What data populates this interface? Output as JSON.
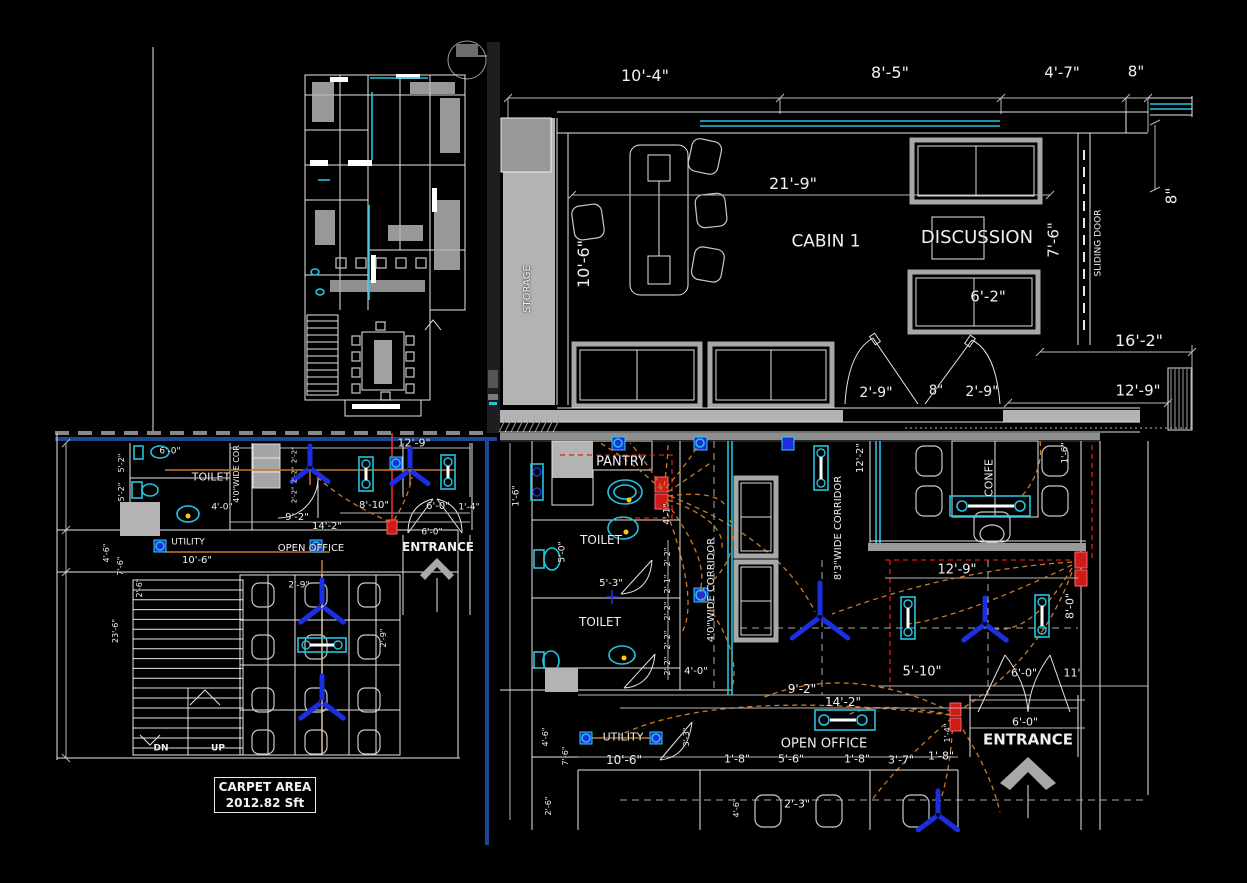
{
  "title": "Office Floor Plan CAD Drawing",
  "colors": {
    "bg": "#000000",
    "line": "#e6e6e6",
    "grayfill": "#b3b3b3",
    "cyan": "#25c4de",
    "blue": "#1c2fe0",
    "orange": "#c87a28",
    "red": "#e01818",
    "navy": "#1c4893",
    "yellow": "#ffcc00",
    "text": "#f0f0f0"
  },
  "carpet_area": {
    "line1": "CARPET AREA",
    "line2": "2012.82 Sft"
  },
  "labels": [
    {
      "n": "dim-10-4",
      "t": "10'-4\"",
      "x": 645,
      "y": 76,
      "s": 16
    },
    {
      "n": "dim-8-5",
      "t": "8'-5\"",
      "x": 890,
      "y": 73,
      "s": 16
    },
    {
      "n": "dim-4-7",
      "t": "4'-7\"",
      "x": 1062,
      "y": 73,
      "s": 15
    },
    {
      "n": "dim-8in-top",
      "t": "8\"",
      "x": 1136,
      "y": 72,
      "s": 15
    },
    {
      "n": "dim-8in-right",
      "t": "8\"",
      "x": 1172,
      "y": 196,
      "s": 15,
      "r": -90
    },
    {
      "n": "dim-21-9",
      "t": "21'-9\"",
      "x": 793,
      "y": 184,
      "s": 16
    },
    {
      "n": "dim-10-6-cabin",
      "t": "10'-6\"",
      "x": 584,
      "y": 264,
      "s": 16,
      "r": -90
    },
    {
      "n": "room-label-cabin1",
      "t": "CABIN 1",
      "x": 826,
      "y": 242,
      "s": 17
    },
    {
      "n": "room-label-discussion",
      "t": "DISCUSSION",
      "x": 977,
      "y": 238,
      "s": 18
    },
    {
      "n": "dim-7-6-right",
      "t": "7'-6\"",
      "x": 1054,
      "y": 240,
      "s": 15,
      "r": -90
    },
    {
      "n": "label-sliding-door",
      "t": "SLIDING DOOR",
      "x": 1099,
      "y": 243,
      "s": 9,
      "r": -90
    },
    {
      "n": "dim-6-2",
      "t": "6'-2\"",
      "x": 988,
      "y": 297,
      "s": 15
    },
    {
      "n": "dim-2-9-a",
      "t": "2'-9\"",
      "x": 876,
      "y": 393,
      "s": 14
    },
    {
      "n": "dim-8in-door",
      "t": "8\"",
      "x": 936,
      "y": 391,
      "s": 13
    },
    {
      "n": "dim-2-9-b",
      "t": "2'-9\"",
      "x": 982,
      "y": 392,
      "s": 14
    },
    {
      "n": "dim-16-2",
      "t": "16'-2\"",
      "x": 1139,
      "y": 341,
      "s": 16
    },
    {
      "n": "dim-12-9-top",
      "t": "12'-9\"",
      "x": 1138,
      "y": 391,
      "s": 15
    },
    {
      "n": "room-label-storage",
      "t": "STORAGE",
      "x": 528,
      "y": 289,
      "s": 10,
      "r": -90
    },
    {
      "n": "dim-12-9-c",
      "t": "12'-9\"",
      "x": 414,
      "y": 443,
      "s": 11
    },
    {
      "n": "dim-6-0-c1",
      "t": "6'-0\"",
      "x": 170,
      "y": 452,
      "s": 9
    },
    {
      "n": "room-label-toilet-c",
      "t": "TOILET",
      "x": 211,
      "y": 477,
      "s": 11
    },
    {
      "n": "dim-5-2-a",
      "t": "5'-2\"",
      "x": 122,
      "y": 463,
      "s": 8,
      "r": -90
    },
    {
      "n": "dim-5-2-b",
      "t": "5'-2\"",
      "x": 122,
      "y": 492,
      "s": 8,
      "r": -90
    },
    {
      "n": "label-cor-c",
      "t": "4'0\"WIDE COR",
      "x": 237,
      "y": 474,
      "s": 8,
      "r": -90
    },
    {
      "n": "dim-2-2-c1",
      "t": "2'-2\"",
      "x": 295,
      "y": 455,
      "s": 7,
      "r": -90
    },
    {
      "n": "dim-2-2-c2",
      "t": "2'-2\"",
      "x": 295,
      "y": 475,
      "s": 7,
      "r": -90
    },
    {
      "n": "dim-2-2-c3",
      "t": "2'-2\"",
      "x": 295,
      "y": 495,
      "s": 7,
      "r": -90
    },
    {
      "n": "dim-4-0-c",
      "t": "4'-0\"",
      "x": 222,
      "y": 508,
      "s": 9
    },
    {
      "n": "dim-8-10",
      "t": "8'-10\"",
      "x": 374,
      "y": 506,
      "s": 10
    },
    {
      "n": "dim-6-0-c2",
      "t": "6'-0\"",
      "x": 438,
      "y": 507,
      "s": 10
    },
    {
      "n": "dim-1-4-c",
      "t": "1'-4\"",
      "x": 469,
      "y": 508,
      "s": 9
    },
    {
      "n": "dim-9-2-c",
      "t": "9'-2\"",
      "x": 297,
      "y": 518,
      "s": 10
    },
    {
      "n": "dim-14-2-c",
      "t": "14'-2\"",
      "x": 327,
      "y": 527,
      "s": 10
    },
    {
      "n": "room-label-utility-c",
      "t": "UTILITY",
      "x": 188,
      "y": 543,
      "s": 9
    },
    {
      "n": "dim-10-6-c",
      "t": "10'-6\"",
      "x": 197,
      "y": 561,
      "s": 10
    },
    {
      "n": "room-label-openoffice-c",
      "t": "OPEN OFFICE",
      "x": 311,
      "y": 549,
      "s": 10
    },
    {
      "n": "room-label-entrance-c",
      "t": "ENTRANCE",
      "x": 438,
      "y": 547,
      "s": 12,
      "b": 1
    },
    {
      "n": "dim-6-0-c3",
      "t": "6'-0\"",
      "x": 432,
      "y": 533,
      "s": 9
    },
    {
      "n": "dim-2-9-c",
      "t": "2'-9\"",
      "x": 299,
      "y": 586,
      "s": 9
    },
    {
      "n": "dim-2-9-c2",
      "t": "2'-9\"",
      "x": 384,
      "y": 638,
      "s": 8,
      "r": -90
    },
    {
      "n": "dim-2-6-c",
      "t": "2'-6\"",
      "x": 140,
      "y": 588,
      "s": 8,
      "r": -90
    },
    {
      "n": "dim-23-6",
      "t": "23'-6\"",
      "x": 116,
      "y": 631,
      "s": 8,
      "r": -90
    },
    {
      "n": "dim-4-6-c",
      "t": "4'-6\"",
      "x": 107,
      "y": 553,
      "s": 8,
      "r": -90
    },
    {
      "n": "dim-7-6-c",
      "t": "7'-6\"",
      "x": 121,
      "y": 566,
      "s": 8,
      "r": -90
    },
    {
      "n": "label-dn",
      "t": "DN",
      "x": 161,
      "y": 749,
      "s": 9,
      "b": 1
    },
    {
      "n": "label-up",
      "t": "UP",
      "x": 218,
      "y": 749,
      "s": 9,
      "b": 1
    },
    {
      "n": "room-label-pantry",
      "t": "PANTRY",
      "x": 621,
      "y": 462,
      "s": 13
    },
    {
      "n": "dim-1-6-d1",
      "t": "1'-6\"",
      "x": 517,
      "y": 496,
      "s": 9,
      "r": -90
    },
    {
      "n": "dim-4-1-d",
      "t": "4'-1\"",
      "x": 668,
      "y": 514,
      "s": 9,
      "r": -90
    },
    {
      "n": "room-label-toilet-d1",
      "t": "TOILET",
      "x": 601,
      "y": 540,
      "s": 12
    },
    {
      "n": "dim-5-0-d",
      "t": "5'-0\"",
      "x": 563,
      "y": 552,
      "s": 9,
      "r": -90
    },
    {
      "n": "dim-5-3-d",
      "t": "5'-3\"",
      "x": 611,
      "y": 584,
      "s": 10
    },
    {
      "n": "room-label-toilet-d2",
      "t": "TOILET",
      "x": 600,
      "y": 622,
      "s": 12
    },
    {
      "n": "dim-2-2-d1",
      "t": "2'-2\"",
      "x": 668,
      "y": 557,
      "s": 8,
      "r": -90
    },
    {
      "n": "dim-2-1-d",
      "t": "2'-1\"",
      "x": 668,
      "y": 584,
      "s": 8,
      "r": -90
    },
    {
      "n": "dim-2-2-d2",
      "t": "2'-2\"",
      "x": 668,
      "y": 611,
      "s": 8,
      "r": -90
    },
    {
      "n": "dim-2-2-d3",
      "t": "2'-2\"",
      "x": 668,
      "y": 640,
      "s": 8,
      "r": -90
    },
    {
      "n": "dim-2-2-d4",
      "t": "2'-2\"",
      "x": 668,
      "y": 666,
      "s": 8,
      "r": -90
    },
    {
      "n": "dim-4-0-d",
      "t": "4'-0\"",
      "x": 696,
      "y": 672,
      "s": 10
    },
    {
      "n": "dim-3-3-d",
      "t": "3'-3\"",
      "x": 687,
      "y": 737,
      "s": 8,
      "r": -90
    },
    {
      "n": "label-corridor-4ft",
      "t": "4'0\"WIDE CORRIDOR",
      "x": 712,
      "y": 590,
      "s": 10,
      "r": -90
    },
    {
      "n": "label-corridor-8ft",
      "t": "8'3\"WIDE CORRIDOR",
      "x": 839,
      "y": 528,
      "s": 10,
      "r": -90
    },
    {
      "n": "dim-12-2-d",
      "t": "12'-2\"",
      "x": 861,
      "y": 458,
      "s": 10,
      "r": -90
    },
    {
      "n": "room-label-confe",
      "t": "CONFE",
      "x": 989,
      "y": 478,
      "s": 11,
      "r": -90
    },
    {
      "n": "dim-1-6-d2",
      "t": "1'-6\"",
      "x": 1066,
      "y": 453,
      "s": 9,
      "r": -90
    },
    {
      "n": "dim-12-9-d",
      "t": "12'-9\"",
      "x": 957,
      "y": 570,
      "s": 13
    },
    {
      "n": "dim-8-0-d",
      "t": "8'-0\"",
      "x": 1070,
      "y": 606,
      "s": 11,
      "r": -90
    },
    {
      "n": "dim-5-10-d",
      "t": "5'-10\"",
      "x": 922,
      "y": 672,
      "s": 13
    },
    {
      "n": "dim-6-0-d1",
      "t": "6'-0\"",
      "x": 1024,
      "y": 673,
      "s": 11
    },
    {
      "n": "dim-11in-d",
      "t": "11\"",
      "x": 1073,
      "y": 673,
      "s": 11
    },
    {
      "n": "dim-9-2-d",
      "t": "9'-2\"",
      "x": 802,
      "y": 689,
      "s": 12
    },
    {
      "n": "dim-14-2-d",
      "t": "14'-2\"",
      "x": 843,
      "y": 702,
      "s": 12
    },
    {
      "n": "dim-1-4-d",
      "t": "1'-4\"",
      "x": 948,
      "y": 733,
      "s": 8,
      "r": -90
    },
    {
      "n": "room-label-openoffice-d",
      "t": "OPEN OFFICE",
      "x": 824,
      "y": 744,
      "s": 13
    },
    {
      "n": "room-label-entrance-d",
      "t": "ENTRANCE",
      "x": 1028,
      "y": 740,
      "s": 15,
      "b": 1
    },
    {
      "n": "dim-6-0-d2",
      "t": "6'-0\"",
      "x": 1025,
      "y": 722,
      "s": 11
    },
    {
      "n": "room-label-utility-d",
      "t": "UTILITY",
      "x": 623,
      "y": 737,
      "s": 11
    },
    {
      "n": "dim-10-6-d",
      "t": "10'-6\"",
      "x": 624,
      "y": 760,
      "s": 12
    },
    {
      "n": "dim-1-8-d1",
      "t": "1'-8\"",
      "x": 737,
      "y": 759,
      "s": 11
    },
    {
      "n": "dim-5-6-d",
      "t": "5'-6\"",
      "x": 791,
      "y": 759,
      "s": 11
    },
    {
      "n": "dim-1-8-d2",
      "t": "1'-8\"",
      "x": 857,
      "y": 759,
      "s": 11
    },
    {
      "n": "dim-3-7-d",
      "t": "3'-7\"",
      "x": 901,
      "y": 760,
      "s": 11
    },
    {
      "n": "dim-1-8-d3",
      "t": "1'-8\"",
      "x": 941,
      "y": 756,
      "s": 11
    },
    {
      "n": "dim-2-3-d",
      "t": "2'-3\"",
      "x": 797,
      "y": 804,
      "s": 11
    },
    {
      "n": "dim-4-6-d1",
      "t": "4'-6\"",
      "x": 737,
      "y": 808,
      "s": 8,
      "r": -90
    },
    {
      "n": "dim-4-6-d2",
      "t": "4'-6\"",
      "x": 546,
      "y": 737,
      "s": 8,
      "r": -90
    },
    {
      "n": "dim-7-6-d",
      "t": "7'-6\"",
      "x": 566,
      "y": 756,
      "s": 8,
      "r": -90
    },
    {
      "n": "dim-2-6-d",
      "t": "2'-6\"",
      "x": 549,
      "y": 806,
      "s": 8,
      "r": -90
    }
  ]
}
